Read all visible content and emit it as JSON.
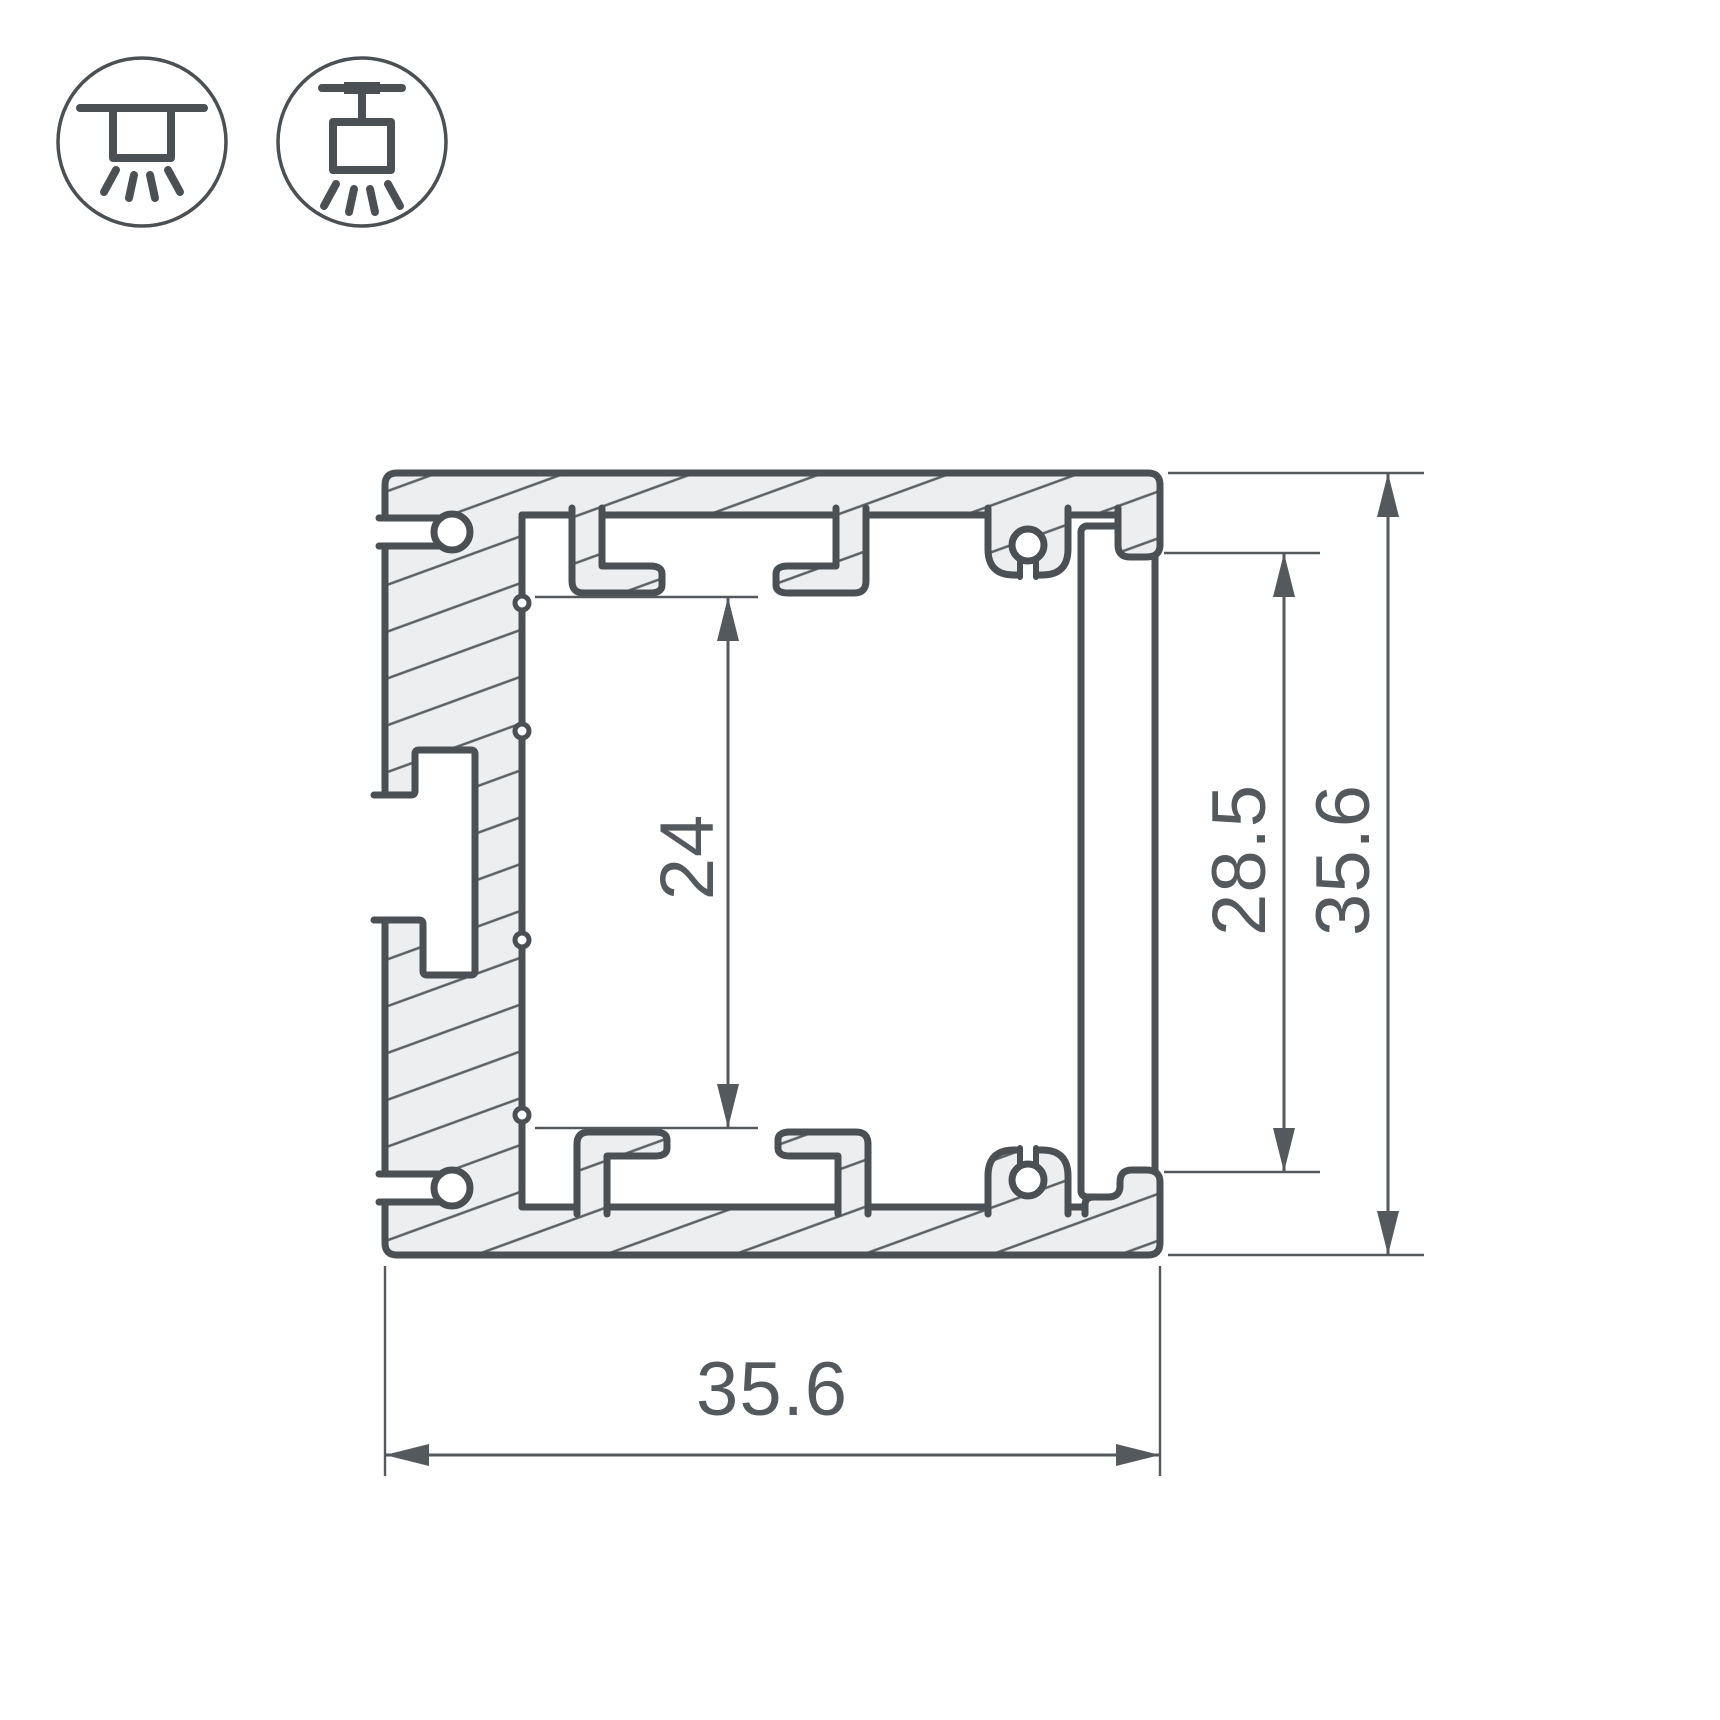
{
  "canvas": {
    "width": 1720,
    "height": 1720,
    "background": "#ffffff"
  },
  "palette": {
    "outline": "#4b5054",
    "hatch_line": "#5a6064",
    "metal_fill": "#edeeef",
    "dim_color": "#54595d",
    "white": "#ffffff"
  },
  "icons": {
    "left": {
      "name": "surface-mount-light-icon"
    },
    "right": {
      "name": "suspended-mount-light-icon"
    }
  },
  "drawing": {
    "type": "aluminium-profile-cross-section",
    "dimensions": {
      "inner_height": {
        "value": "24",
        "orientation": "vertical"
      },
      "screen_length": {
        "value": "28.5",
        "orientation": "vertical"
      },
      "overall_height": {
        "value": "35.6",
        "orientation": "vertical"
      },
      "overall_width": {
        "value": "35.6",
        "orientation": "horizontal"
      }
    }
  }
}
